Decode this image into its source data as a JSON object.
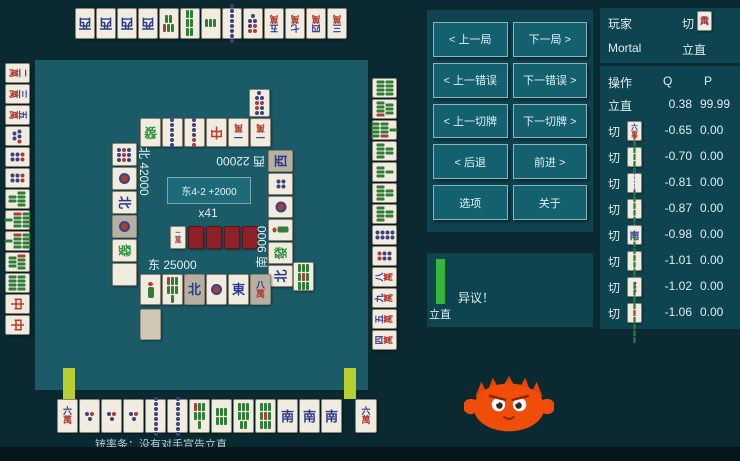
{
  "nav": {
    "buttons": [
      "< 上一局",
      "下一局 >",
      "< 上一错误",
      "下一错误 >",
      "< 上一切牌",
      "下一切牌 >",
      "< 后退",
      "前进 >",
      "选项",
      "关于"
    ]
  },
  "review": {
    "player_label": "玩家",
    "player_action": "切",
    "player_tile": [
      "6m"
    ],
    "mortal_label": "Mortal",
    "mortal_action": "立直",
    "table": {
      "headers": [
        "操作",
        "Q",
        "P"
      ],
      "rows": [
        {
          "action": "立直",
          "tile": null,
          "q": "0.38",
          "p": "99.99"
        },
        {
          "action": "切",
          "tile": "6m",
          "q": "-0.65",
          "p": "0.00"
        },
        {
          "action": "切",
          "tile": "7s",
          "q": "-0.70",
          "p": "0.00"
        },
        {
          "action": "切",
          "tile": "8p",
          "q": "-0.81",
          "p": "0.00"
        },
        {
          "action": "切",
          "tile": "6s",
          "q": "-0.87",
          "p": "0.00"
        },
        {
          "action": "切",
          "tile": "S",
          "q": "-0.98",
          "p": "0.00"
        },
        {
          "action": "切",
          "tile": "8s",
          "q": "-1.01",
          "p": "0.00"
        },
        {
          "action": "切",
          "tile": "3p",
          "q": "-1.02",
          "p": "0.00"
        },
        {
          "action": "切",
          "tile": "9s",
          "q": "-1.06",
          "p": "0.00"
        }
      ]
    }
  },
  "actionbar": {
    "label": "立直",
    "objection": "异议！"
  },
  "board": {
    "center": {
      "round": "东4-2 +2000",
      "tiles_left": "x41"
    },
    "dora": [
      "2m",
      "back",
      "back",
      "back",
      "back"
    ],
    "scores": {
      "east": "东 25000",
      "south": "南 9000",
      "west": "西 22000",
      "north": "北 42000"
    },
    "hands": {
      "east": [
        "6m",
        "3p",
        "3p",
        "3p",
        "8p",
        "8p",
        "7s",
        "6s",
        "8s",
        "9s",
        "S",
        "S",
        "S"
      ],
      "east_draw": [
        "6m"
      ],
      "north": [
        "2m",
        "3m",
        "5m",
        "5p",
        "6p",
        "6p",
        "6s",
        "9s",
        "9s",
        "7s",
        "8s",
        "C",
        "C"
      ],
      "west": [
        "W",
        "W",
        "W",
        "W",
        "5s",
        "6s",
        "3s",
        "8p",
        "7p",
        "5m",
        "7m",
        "4m",
        "3m"
      ],
      "south": [
        "8s",
        "7s",
        "9s",
        "6s",
        "4s",
        "6s",
        "6s",
        "8p",
        "6p",
        "8m",
        "9m",
        "5m",
        "4m"
      ]
    },
    "discards": {
      "west": [
        "F",
        "8p",
        "6p",
        "C",
        "1m",
        "1m"
      ],
      "west_row2": [
        "9p"
      ],
      "north": [
        "9p",
        "1p",
        "N",
        "1p*",
        "F",
        "H"
      ],
      "south": [
        "W*",
        "4p",
        "1p",
        "1s",
        "F",
        "N"
      ],
      "south_row2": [
        "9s"
      ],
      "east": [
        "1s",
        "7s",
        "N*",
        "1p",
        "E",
        "8m*"
      ],
      "east_extra": [
        "blank"
      ]
    },
    "deal_in_caption": "铳率条：没有对手宣告立直"
  },
  "tile_defs": {
    "1m": {
      "type": "man",
      "char": "一",
      "bottom": "萬"
    },
    "2m": {
      "type": "man",
      "char": "二",
      "bottom": "萬"
    },
    "3m": {
      "type": "man",
      "char": "三",
      "bottom": "萬"
    },
    "4m": {
      "type": "man",
      "char": "四",
      "bottom": "萬"
    },
    "5m": {
      "type": "man",
      "char": "五",
      "bottom": "萬"
    },
    "6m": {
      "type": "man",
      "char": "六",
      "bottom": "萬"
    },
    "7m": {
      "type": "man",
      "char": "七",
      "bottom": "萬"
    },
    "8m": {
      "type": "man",
      "char": "八",
      "bottom": "萬"
    },
    "9m": {
      "type": "man",
      "char": "九",
      "bottom": "萬"
    },
    "1p": {
      "type": "pin",
      "n": 1
    },
    "3p": {
      "type": "pin",
      "n": 3,
      "red": [
        1
      ]
    },
    "4p": {
      "type": "pin",
      "n": 4,
      "cols": 2
    },
    "5p": {
      "type": "pin",
      "n": 5,
      "red": [
        2
      ]
    },
    "6p": {
      "type": "pin",
      "n": 6,
      "cols": 2,
      "red": [
        0,
        1
      ]
    },
    "7p": {
      "type": "pin",
      "n": 7,
      "red": [
        0,
        1,
        2
      ]
    },
    "8p": {
      "type": "pin",
      "n": 8,
      "cols": 2
    },
    "9p": {
      "type": "pin",
      "n": 9,
      "red": [
        3,
        4,
        5
      ]
    },
    "1s": {
      "type": "bird"
    },
    "3s": {
      "type": "sou",
      "n": 3
    },
    "4s": {
      "type": "sou",
      "n": 4,
      "cols": 2
    },
    "5s": {
      "type": "sou",
      "n": 5,
      "red": [
        2
      ]
    },
    "6s": {
      "type": "sou",
      "n": 6,
      "cols": 3
    },
    "7s": {
      "type": "sou",
      "n": 7,
      "cols": 3,
      "red": [
        0
      ]
    },
    "8s": {
      "type": "sou",
      "n": 8,
      "cols": 3
    },
    "9s": {
      "type": "sou",
      "n": 9,
      "cols": 3,
      "red": [
        4
      ]
    },
    "E": {
      "type": "char",
      "char": "東",
      "color": "#2b3a8c"
    },
    "S": {
      "type": "char",
      "char": "南",
      "color": "#2b3a8c"
    },
    "W": {
      "type": "char",
      "char": "西",
      "color": "#2b3a8c"
    },
    "N": {
      "type": "char",
      "char": "北",
      "color": "#2b3a8c"
    },
    "C": {
      "type": "char",
      "char": "中",
      "color": "#bf3a2b"
    },
    "F": {
      "type": "char",
      "char": "發",
      "color": "#2f8f3c"
    },
    "H": {
      "type": "haku"
    },
    "back": {
      "type": "back"
    },
    "blank": {
      "type": "blank"
    }
  },
  "colors": {
    "page_bg": "#0a2931",
    "board_bg": "#1a5b67",
    "panel_bg": "#0d4450",
    "button_bg": "#13606e",
    "riichi_bar_green": "#36b43b",
    "deal_in_bar_yellow": "#b9cf2e",
    "tile_back_red": "#8e2127",
    "ferris_orange": "#f04c0a"
  }
}
